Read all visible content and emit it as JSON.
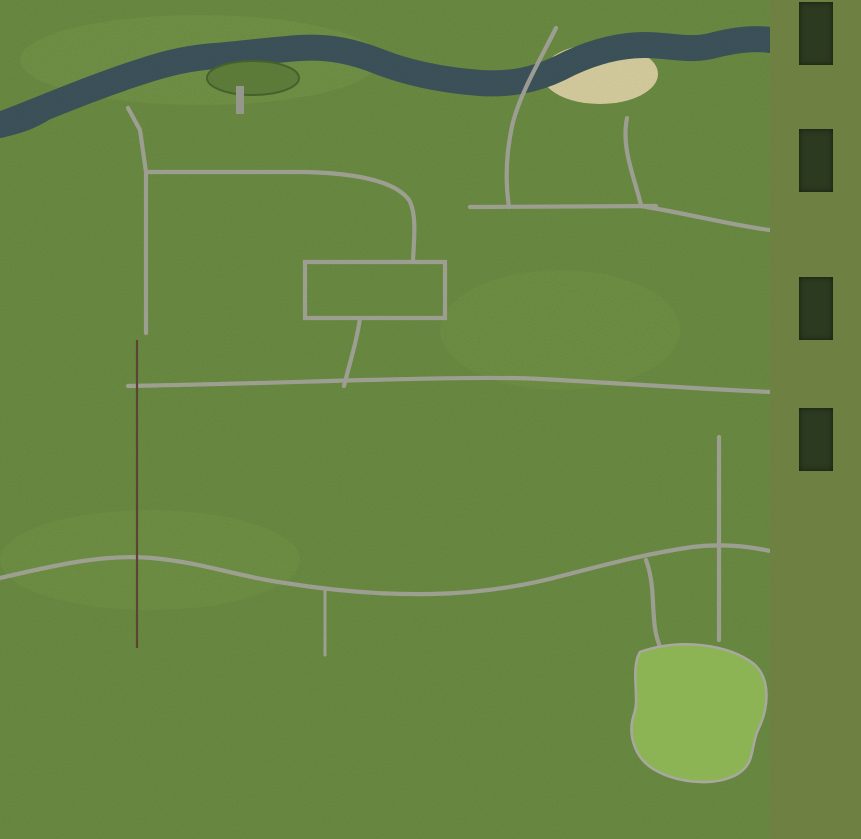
{
  "page": {
    "bg_color": "#6e8142"
  },
  "legend": {
    "label_color": "#c8322a",
    "tile_color": "#2c3a20",
    "items": [
      {
        "id": "wheat",
        "icon": "wheat-icon",
        "label_lines": [
          "Wheat"
        ]
      },
      {
        "id": "barley",
        "icon": "barley-icon",
        "label_lines": [
          "Barley"
        ]
      },
      {
        "id": "canola",
        "icon": "canola-icon",
        "label_lines": [
          "Canola",
          "(Rapeseed)"
        ]
      },
      {
        "id": "corn",
        "icon": "corn-icon",
        "label_lines": [
          "Corn"
        ]
      }
    ]
  },
  "map": {
    "label_color": "#e60000",
    "field_number_color": "#d6e63a",
    "marker_color": "#ffffff",
    "fields": [
      {
        "num": "1",
        "x": 32,
        "y": 122,
        "w": 114,
        "h": 198,
        "nx": 85,
        "ny": 212
      },
      {
        "num": "2",
        "x": 158,
        "y": 132,
        "w": 114,
        "h": 34,
        "nx": 209,
        "ny": 150
      },
      {
        "num": "3",
        "x": 153,
        "y": 183,
        "w": 175,
        "h": 43,
        "nx": 241,
        "ny": 205
      },
      {
        "num": "4",
        "x": 334,
        "y": 84,
        "w": 97,
        "h": 82,
        "nx": 384,
        "ny": 125
      },
      {
        "num": "5",
        "x": 436,
        "y": 90,
        "w": 58,
        "h": 42,
        "nx": 465,
        "ny": 112
      },
      {
        "num": "6",
        "x": 470,
        "y": 209,
        "w": 39,
        "h": 54,
        "nx": 489,
        "ny": 232
      },
      {
        "num": "7",
        "x": 508,
        "y": 206,
        "w": 149,
        "h": 79,
        "nx": 583,
        "ny": 245
      },
      {
        "num": "8",
        "x": 584,
        "y": 161,
        "w": 46,
        "h": 39,
        "nx": 608,
        "ny": 181
      },
      {
        "num": "9",
        "x": 642,
        "y": 156,
        "w": 23,
        "h": 33,
        "nx": 655,
        "ny": 172
      },
      {
        "num": "10",
        "x": 18,
        "y": 354,
        "w": 104,
        "h": 77,
        "nx": 69,
        "ny": 393
      },
      {
        "num": "11",
        "x": 33,
        "y": 434,
        "w": 39,
        "h": 63,
        "nx": 51,
        "ny": 469
      },
      {
        "num": "12",
        "x": 76,
        "y": 432,
        "w": 56,
        "h": 56,
        "nx": 105,
        "ny": 461
      },
      {
        "num": "13",
        "x": 198,
        "y": 274,
        "w": 81,
        "h": 56,
        "nx": 230,
        "ny": 305
      },
      {
        "num": "14",
        "x": 231,
        "y": 384,
        "w": 104,
        "h": 56,
        "nx": 283,
        "ny": 413
      },
      {
        "num": "15",
        "x": 238,
        "y": 440,
        "w": 40,
        "h": 27,
        "nx": 258,
        "ny": 453
      },
      {
        "num": "16",
        "x": 284,
        "y": 440,
        "w": 38,
        "h": 27,
        "nx": 302,
        "ny": 453
      },
      {
        "num": "17",
        "x": 423,
        "y": 372,
        "w": 63,
        "h": 89,
        "nx": 456,
        "ny": 416
      },
      {
        "num": "18",
        "x": 487,
        "y": 394,
        "w": 38,
        "h": 64,
        "nx": 506,
        "ny": 424
      },
      {
        "num": "19",
        "x": 529,
        "y": 394,
        "w": 35,
        "h": 57,
        "nx": 548,
        "ny": 420
      },
      {
        "num": "20",
        "x": 522,
        "y": 334,
        "w": 106,
        "h": 49,
        "nx": 577,
        "ny": 361
      },
      {
        "num": "21",
        "x": 630,
        "y": 332,
        "w": 48,
        "h": 51,
        "nx": 654,
        "ny": 359
      },
      {
        "num": "22",
        "x": 711,
        "y": 249,
        "w": 52,
        "h": 56,
        "nx": 734,
        "ny": 275
      },
      {
        "num": "23",
        "x": 715,
        "y": 317,
        "w": 53,
        "h": 83,
        "nx": 743,
        "ny": 362
      },
      {
        "num": "24",
        "x": 207,
        "y": 535,
        "w": 56,
        "h": 39,
        "nx": 237,
        "ny": 556
      },
      {
        "num": "25",
        "x": 207,
        "y": 597,
        "w": 47,
        "h": 46,
        "nx": 230,
        "ny": 619
      },
      {
        "num": "26",
        "x": 274,
        "y": 507,
        "w": 90,
        "h": 27,
        "nx": 319,
        "ny": 522
      },
      {
        "num": "27",
        "x": 369,
        "y": 497,
        "w": 111,
        "h": 43,
        "nx": 416,
        "ny": 520
      },
      {
        "num": "28",
        "x": 334,
        "y": 595,
        "w": 54,
        "h": 43,
        "nx": 367,
        "ny": 622
      },
      {
        "num": "29",
        "x": 514,
        "y": 497,
        "w": 59,
        "h": 49,
        "nx": 543,
        "ny": 520
      },
      {
        "num": "30",
        "x": 514,
        "y": 565,
        "w": 56,
        "h": 39,
        "nx": 541,
        "ny": 586
      },
      {
        "num": "31",
        "x": 664,
        "y": 450,
        "w": 49,
        "h": 73,
        "nx": 689,
        "ny": 499
      },
      {
        "num": "32",
        "x": 720,
        "y": 458,
        "w": 45,
        "h": 65,
        "nx": 735,
        "ny": 499
      },
      {
        "num": "33",
        "x": 662,
        "y": 557,
        "w": 51,
        "h": 73,
        "nx": 688,
        "ny": 599
      },
      {
        "num": "34",
        "x": 722,
        "y": 557,
        "w": 43,
        "h": 73,
        "nx": 738,
        "ny": 599
      },
      {
        "num": "35",
        "x": 494,
        "y": 657,
        "w": 37,
        "h": 55,
        "nx": 516,
        "ny": 685
      },
      {
        "num": "36",
        "x": 597,
        "y": 667,
        "w": 38,
        "h": 71,
        "nx": 616,
        "ny": 706
      },
      {
        "num": "37",
        "x": 16,
        "y": 639,
        "w": 89,
        "h": 89,
        "nx": 65,
        "ny": 684
      },
      {
        "num": "38",
        "x": 104,
        "y": 684,
        "w": 81,
        "h": 49,
        "nx": 140,
        "ny": 707
      },
      {
        "num": "39",
        "x": 24,
        "y": 739,
        "w": 153,
        "h": 75,
        "nx": 97,
        "ny": 776
      },
      {
        "num": "40",
        "x": 245,
        "y": 687,
        "w": 156,
        "h": 129,
        "nx": 317,
        "ny": 756
      },
      {
        "num": "41",
        "x": 507,
        "y": 764,
        "w": 125,
        "h": 49,
        "nx": 568,
        "ny": 795
      },
      {
        "num": "42",
        "x": 634,
        "y": 784,
        "w": 65,
        "h": 34,
        "nx": 674,
        "ny": 803
      }
    ],
    "markers": [
      {
        "id": "a",
        "letter": "A",
        "x": 86,
        "y": 75
      },
      {
        "id": "b",
        "letter": "B",
        "x": 289,
        "y": 146
      },
      {
        "id": "c",
        "letter": "C",
        "x": 317,
        "y": 303
      },
      {
        "id": "d",
        "letter": "D",
        "x": 394,
        "y": 281
      },
      {
        "id": "e",
        "letter": "E",
        "x": 520,
        "y": 161
      },
      {
        "id": "f",
        "letter": "F",
        "x": 629,
        "y": 113
      },
      {
        "id": "g",
        "letter": "G",
        "x": 637,
        "y": 202
      },
      {
        "id": "h",
        "letter": "H",
        "x": 145,
        "y": 386
      },
      {
        "id": "i",
        "letter": "I",
        "x": 371,
        "y": 416
      },
      {
        "id": "j",
        "letter": "J",
        "x": 611,
        "y": 388
      },
      {
        "id": "k",
        "letter": "K",
        "x": 586,
        "y": 501
      },
      {
        "id": "l-west",
        "letter": "L",
        "x": 20,
        "y": 567
      },
      {
        "id": "l-east",
        "letter": "L",
        "x": 732,
        "y": 543
      },
      {
        "id": "m",
        "letter": "M",
        "x": 134,
        "y": 663
      },
      {
        "id": "n",
        "letter": "N",
        "x": 269,
        "y": 606
      },
      {
        "id": "o",
        "letter": "O",
        "x": 448,
        "y": 598
      },
      {
        "id": "p",
        "letter": "P",
        "x": 480,
        "y": 694
      },
      {
        "id": "q",
        "letter": "Q",
        "x": 703,
        "y": 726
      }
    ],
    "labels": [
      {
        "id": "port",
        "lines": [
          "Port"
        ],
        "x": 101,
        "y": 63
      },
      {
        "id": "farm-shop",
        "lines": [
          "Farm",
          "shop"
        ],
        "x": 302,
        "y": 122
      },
      {
        "id": "biogas-plant",
        "lines": [
          "Biogas",
          "plant"
        ],
        "x": 451,
        "y": 133
      },
      {
        "id": "camping-site",
        "lines": [
          "Camping",
          "site"
        ],
        "x": 644,
        "y": 92
      },
      {
        "id": "inn",
        "lines": [
          "Inn"
        ],
        "x": 668,
        "y": 191
      },
      {
        "id": "vehicle-shop",
        "lines": [
          "Vehicle",
          "shop"
        ],
        "x": 287,
        "y": 243
      },
      {
        "id": "village",
        "lines": [
          "Village"
        ],
        "x": 377,
        "y": 243
      },
      {
        "id": "freight-yard",
        "lines": [
          "Freight yard"
        ],
        "x": 60,
        "y": 330
      },
      {
        "id": "farm",
        "lines": [
          "Farm"
        ],
        "x": 362,
        "y": 429
      },
      {
        "id": "dairy",
        "lines": [
          "Dairy"
        ],
        "x": 599,
        "y": 406
      },
      {
        "id": "garden-center",
        "lines": [
          "Garden center"
        ],
        "x": 472,
        "y": 470
      },
      {
        "id": "water-tower-west",
        "lines": [
          "Water tower"
        ],
        "x": 8,
        "y": 536
      },
      {
        "id": "water-tower-east",
        "lines": [
          "Water",
          "tower"
        ],
        "x": 662,
        "y": 527
      },
      {
        "id": "sheep-pasture",
        "lines": [
          "Sheep",
          "pasture"
        ],
        "x": 110,
        "y": 611
      },
      {
        "id": "grain-mill",
        "lines": [
          "Grain Mill"
        ],
        "x": 252,
        "y": 570
      },
      {
        "id": "spinnery",
        "lines": [
          "Spinnery"
        ],
        "x": 410,
        "y": 611
      },
      {
        "id": "cow-pasture",
        "lines": [
          "Cow pasture"
        ],
        "x": 422,
        "y": 704
      },
      {
        "id": "golf-course",
        "lines": [
          "Golf course"
        ],
        "x": 642,
        "y": 737
      }
    ]
  }
}
